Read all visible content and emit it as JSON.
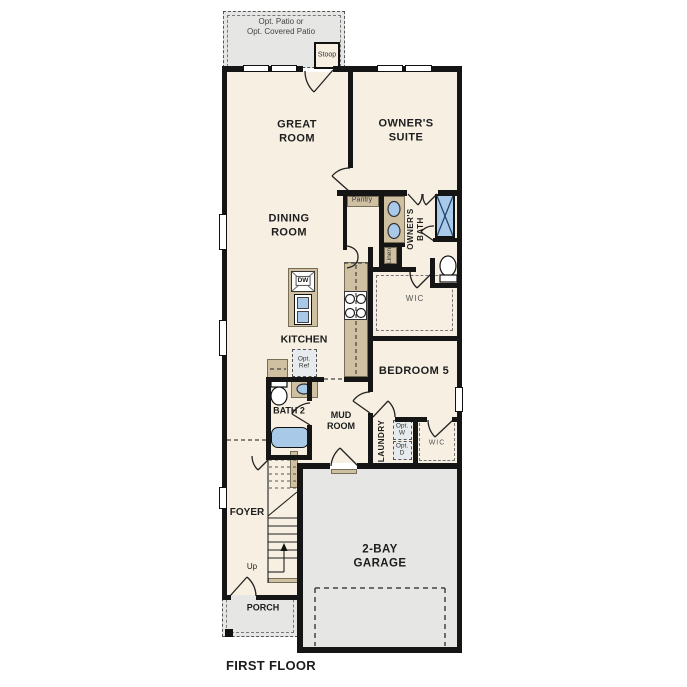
{
  "plan": {
    "title": "FIRST FLOOR",
    "outdoor": {
      "patio": "Opt. Patio or\nOpt. Covered Patio",
      "stoop": "Stoop",
      "porch": "PORCH"
    },
    "rooms": {
      "great_room": "GREAT\nROOM",
      "owners_suite": "OWNER'S\nSUITE",
      "dining_room": "DINING\nROOM",
      "kitchen": "KITCHEN",
      "pantry": "Pantry",
      "owners_bath": "OWNER'S\nBATH",
      "linen": "Linen",
      "owners_wic": "WIC",
      "bath_2": "BATH 2",
      "mud_room": "MUD\nROOM",
      "bedroom_5": "BEDROOM 5",
      "laundry": "LAUNDRY",
      "bedroom_wic": "WIC",
      "foyer": "FOYER",
      "garage": "2-BAY\nGARAGE"
    },
    "annotations": {
      "dw": "DW",
      "opt_ref": "Opt.\nRef",
      "opt_washer": "Opt.\nW",
      "opt_dryer": "Opt.\nD",
      "up": "Up"
    },
    "colors": {
      "floor": "#f6efe2",
      "outdoor": "#e6e6e4",
      "wall": "#151515",
      "tan": "#cfc0a2",
      "blue": "#a9c9e9",
      "appl": "#e8ebed",
      "dash": "#555555"
    }
  }
}
